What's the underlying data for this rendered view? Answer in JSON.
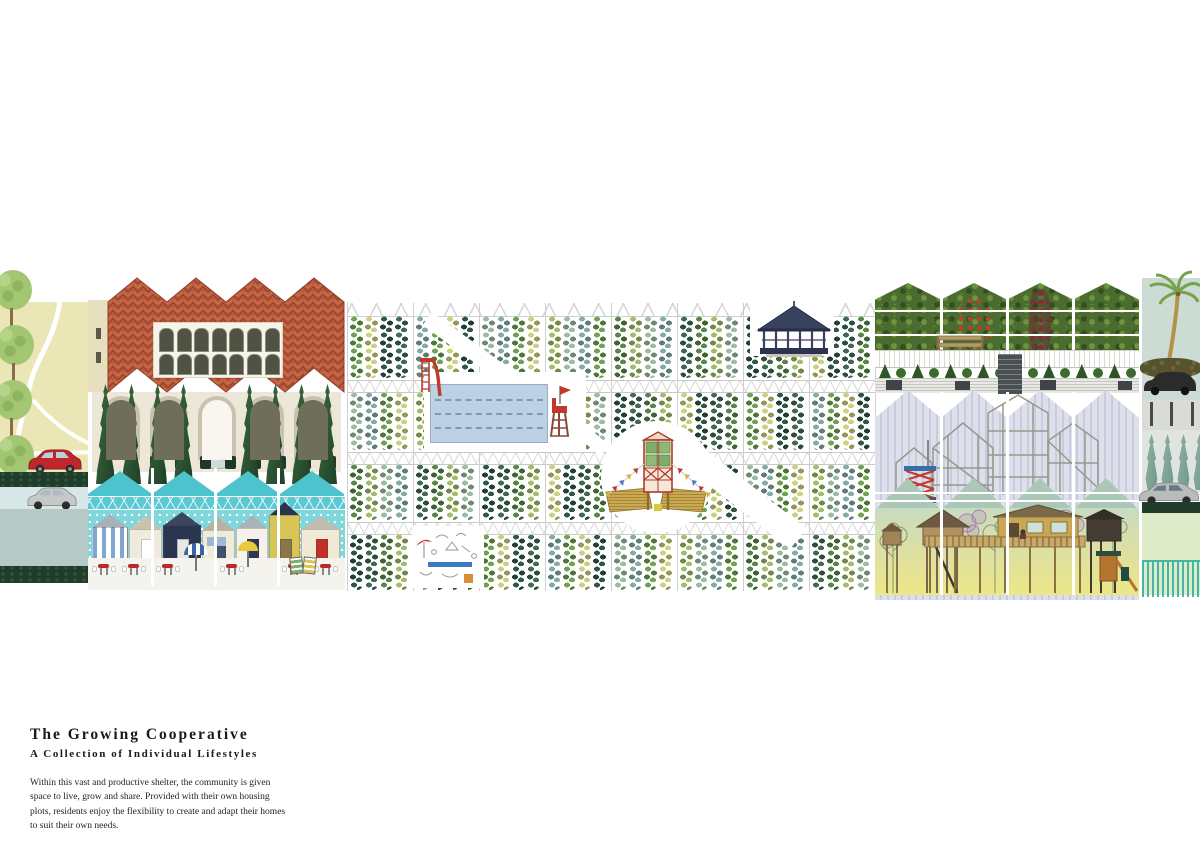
{
  "poster": {
    "title": "The Growing Cooperative",
    "subtitle": "A Collection of Individual Lifestyles",
    "description": "Within this vast and productive shelter, the community is given space to live, grow and share. Provided with their own housing plots, residents enjoy the flexibility to create and adapt their homes to suit their own needs."
  },
  "palette": {
    "meadow": "#eae6b6",
    "hedge_strip": "#203d2c",
    "sage_block": "#b7c9c6",
    "pale_road": "#d7e6e6",
    "roof_terracotta": "#bb5a3c",
    "roof_line": "#93402a",
    "arcade_wall": "#ece7d9",
    "cypress_dark": "#2c5233",
    "canopy_turquoise": "#4cc3cd",
    "beach_sky": "#7fd6db",
    "sand": "#f4f3ee",
    "pool_water": "#bdd1e4",
    "gazebo_navy": "#39425e",
    "tower_red": "#b33a2a",
    "straw": "#c9aa52",
    "stripe_wall_a": "#dde0ea",
    "stripe_wall_b": "#c7cddd",
    "sage_gable": "#abc7b7",
    "treehouse_wood": "#c9a853",
    "teal_fence": "#45b5a6",
    "far_bg": "#ccdcd5"
  },
  "illustration": {
    "field": {
      "palette": [
        "#6fa34e",
        "#3f6b53",
        "#9dbda2",
        "#ccd27c",
        "#57884a",
        "#84aca7",
        "#2e5746",
        "#a3bd68"
      ]
    },
    "beach_huts": [
      {
        "w": 36,
        "h": 46,
        "body": "#ffffff",
        "stripe": "#7fa7d0",
        "roof": "#a8b0b8",
        "door": null,
        "sign": null
      },
      {
        "w": 33,
        "h": 44,
        "body": "#efeadb",
        "stripe": null,
        "roof": "#c8c2b0",
        "door": "#ffffff",
        "sign": null
      },
      {
        "w": 38,
        "h": 48,
        "body": "#2c3550",
        "stripe": null,
        "roof": "#3a4560",
        "door": "#e8e8e4",
        "sign": null
      },
      {
        "w": 33,
        "h": 43,
        "body": "#f0ead8",
        "stripe": null,
        "roof": "#b8b2a0",
        "door": "#44506e",
        "sign": "#9db8d8"
      },
      {
        "w": 32,
        "h": 45,
        "body": "#f4f2ea",
        "stripe": null,
        "roof": "#aab2ba",
        "door": "#2c3550",
        "sign": null
      },
      {
        "w": 31,
        "h": 58,
        "body": "#d9c557",
        "stripe": null,
        "roof": "#2c3550",
        "door": "#8a7648",
        "sign": null
      },
      {
        "w": 39,
        "h": 44,
        "body": "#efe9d6",
        "stripe": null,
        "roof": "#c0bcae",
        "door": "#c03028",
        "sign": null
      }
    ],
    "hedge_panels": [
      "plain",
      "red-flowers",
      "vine",
      "plain"
    ],
    "bunting_colors": [
      "#c0392b",
      "#d9b23a",
      "#4a7ab5"
    ],
    "cars": [
      {
        "name": "red-hatchback",
        "color": "#c0272d"
      },
      {
        "name": "silver-hatchback",
        "color": "#c6c9c8"
      },
      {
        "name": "overgrown-car",
        "color": "#2b2b2b"
      },
      {
        "name": "silver-sedan",
        "color": "#b9bcbc"
      }
    ],
    "features": [
      "street-trees",
      "pavilion",
      "courtyard-fountain",
      "beach-huts",
      "crop-rows",
      "swimming-pool",
      "lifeguard-chair",
      "water-slide",
      "bandstand-gazebo",
      "harvest-tower",
      "hedge-garden",
      "garden-bench",
      "picket-fence",
      "topiary-row",
      "timber-house-frames",
      "scissor-lift",
      "stilt-treehouses",
      "palm-tree",
      "cypress-row",
      "teal-fence"
    ]
  }
}
